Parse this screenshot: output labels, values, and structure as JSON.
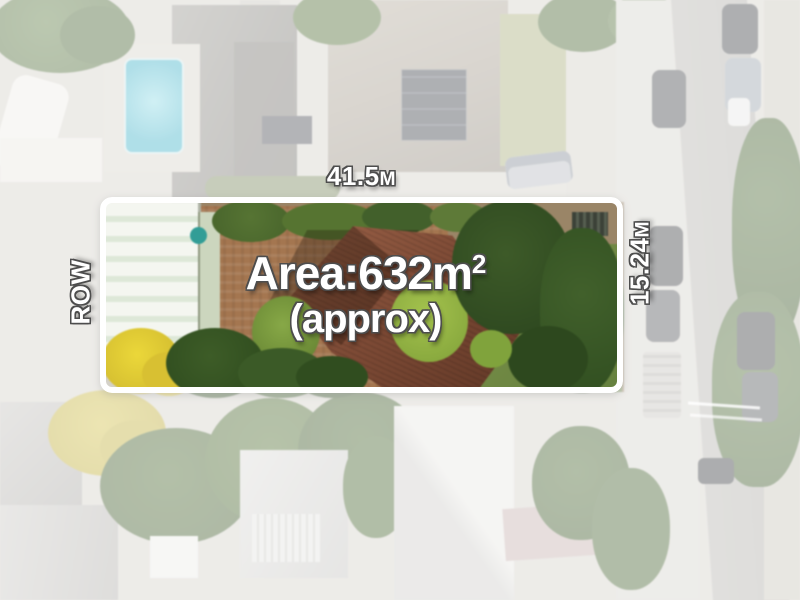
{
  "annotations": {
    "frontage": {
      "value": "41.5",
      "unit": "M"
    },
    "depth": {
      "value": "15.24",
      "unit": "M"
    },
    "row": "ROW",
    "area": {
      "text": "Area:632m",
      "sup": "2"
    },
    "approx": "(approx)"
  },
  "colors": {
    "boundary_line": "#ffffff",
    "exterior_fade": "rgba(255,255,255,0.58)",
    "label_fill": "#ffffff",
    "label_outline": "#4d4d4d",
    "swimming_pool": "#3fb3c9",
    "main_roof_terracotta": "#7c4833",
    "yellow_tree": "#e0c92f"
  }
}
